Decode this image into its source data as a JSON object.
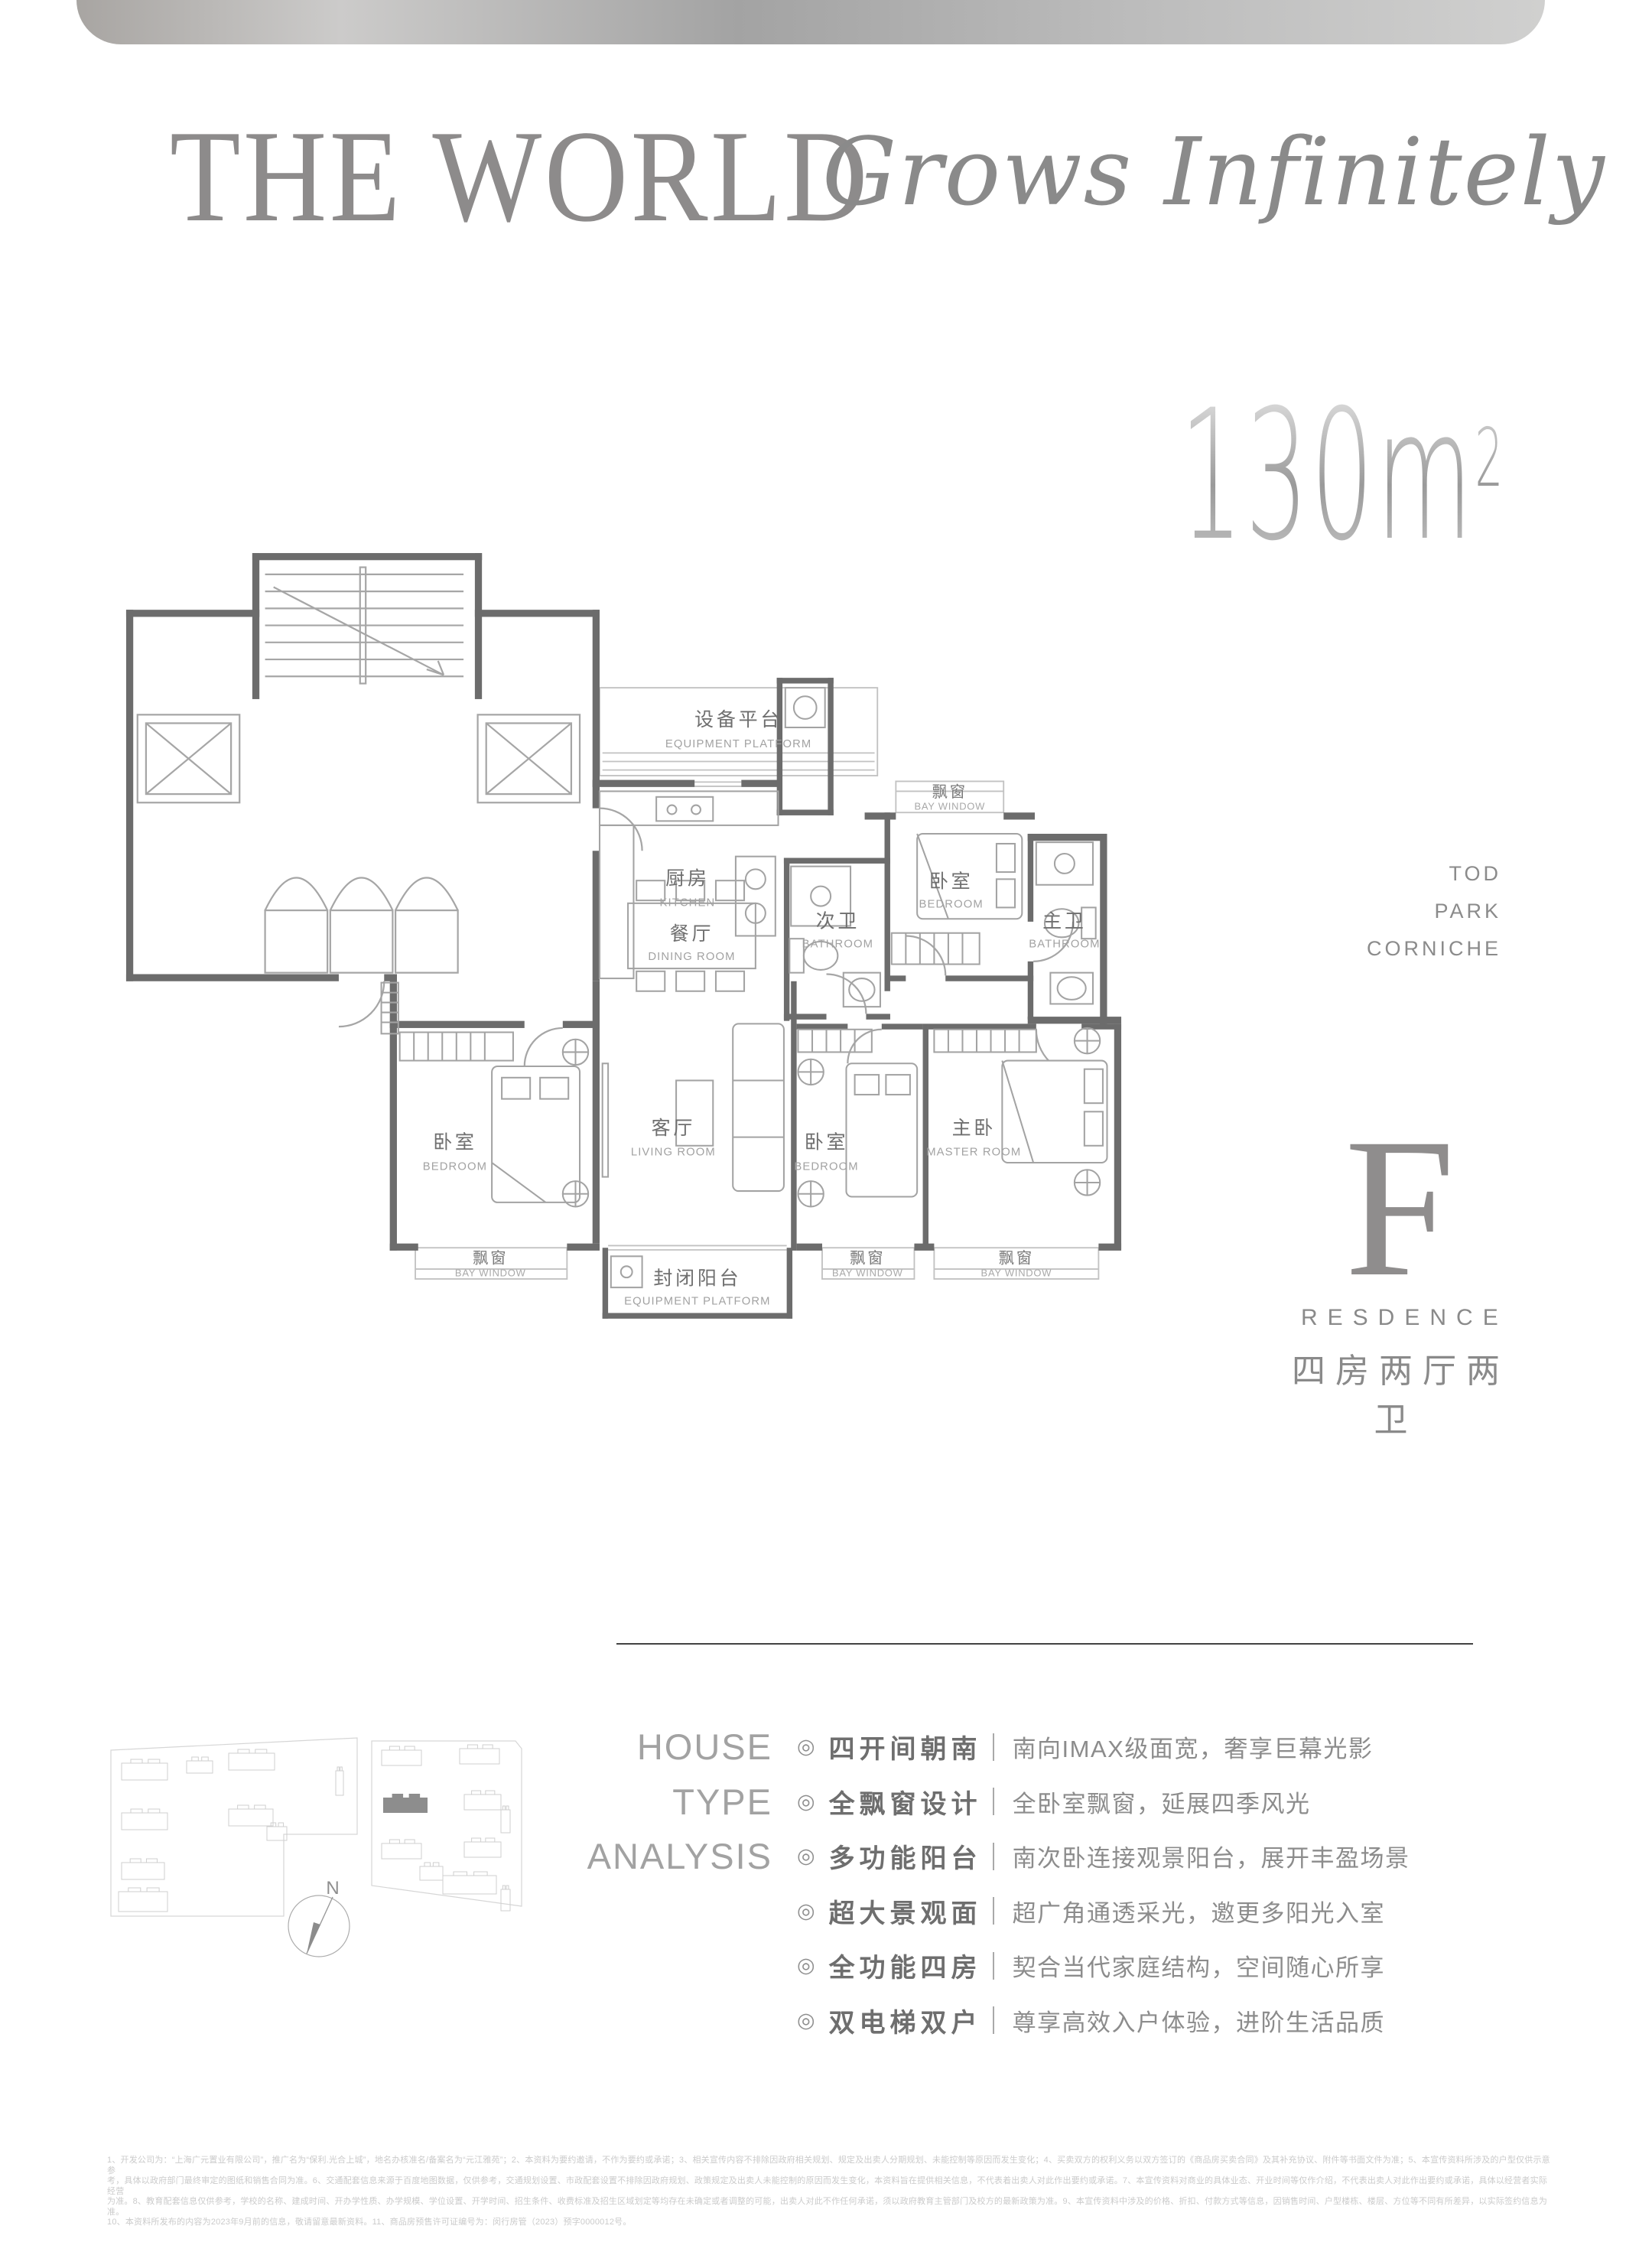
{
  "header": {
    "title": "THE WORLD",
    "subtitle": "Grows Infinitely"
  },
  "area_badge": {
    "value": "130",
    "unit": "m",
    "exponent": "2"
  },
  "location_tags": {
    "0": "TOD",
    "1": "PARK",
    "2": "CORNICHE"
  },
  "residence": {
    "letter": "F",
    "label": "RESDENCE",
    "type": "四房两厅两卫"
  },
  "plan": {
    "rooms": {
      "equipment_platform": {
        "zh": "设备平台",
        "en": "EQUIPMENT PLATFORM"
      },
      "kitchen": {
        "zh": "厨房",
        "en": "KITCHEN"
      },
      "dining": {
        "zh": "餐厅",
        "en": "DINING ROOM"
      },
      "bath_second": {
        "zh": "次卫",
        "en": "BATHROOM"
      },
      "bath_master": {
        "zh": "主卫",
        "en": "BATHROOM"
      },
      "bedroom_north": {
        "zh": "卧室",
        "en": "BEDROOM"
      },
      "bedroom_west": {
        "zh": "卧室",
        "en": "BEDROOM"
      },
      "bedroom_south": {
        "zh": "卧室",
        "en": "BEDROOM"
      },
      "living": {
        "zh": "客厅",
        "en": "LIVING ROOM"
      },
      "master": {
        "zh": "主卧",
        "en": "MASTER ROOM"
      },
      "bay": {
        "zh": "飘窗",
        "en": "BAY WINDOW"
      },
      "balcony": {
        "zh": "封闭阳台",
        "en": "EQUIPMENT PLATFORM"
      }
    }
  },
  "compass": {
    "label": "N"
  },
  "analysis": {
    "heading": {
      "0": "HOUSE",
      "1": "TYPE",
      "2": "ANALYSIS"
    },
    "bullet": "◎",
    "items": [
      {
        "title": "四开间朝南",
        "desc": "南向IMAX级面宽，奢享巨幕光影"
      },
      {
        "title": "全飘窗设计",
        "desc": "全卧室飘窗，延展四季风光"
      },
      {
        "title": "多功能阳台",
        "desc": "南次卧连接观景阳台，展开丰盈场景"
      },
      {
        "title": "超大景观面",
        "desc": "超广角通透采光，邀更多阳光入室"
      },
      {
        "title": "全功能四房",
        "desc": "契合当代家庭结构，空间随心所享"
      },
      {
        "title": "双电梯双户",
        "desc": "尊享高效入户体验，进阶生活品质"
      }
    ]
  },
  "disclaimer": {
    "lines": [
      "1、开发公司为：“上海广元置业有限公司”，推广名为“保利.光合上城”，地名办核准名/备案名为“元江雅苑”；2、本资料为要约邀请，不作为要约或承诺；3、相关宣传内容不排除因政府相关规划、规定及出卖人分期规划、未能控制等原因而发生变化；4、买卖双方的权利义务以双方签订的《商品房买卖合同》及其补充协议、附件等书面文件为准；5、本宣传资料所涉及的户型仅供示意参",
      "考，具体以政府部门最终审定的图纸和销售合同为准。6、交通配套信息来源于百度地图数据，仅供参考，交通规划设置、市政配套设置不排除因政府规划、政策规定及出卖人未能控制的原因而发生变化，本资料旨在提供相关信息，不代表着出卖人对此作出要约或承诺。7、本宣传资料对商业的具体业态、开业时间等仅作介绍，不代表出卖人对此作出要约或承诺，具体以经营者实际经营",
      "为准。8、教育配套信息仅供参考，学校的名称、建成时间、开办学性质、办学规模、学位设置、开学时间、招生条件、收费标准及招生区域划定等均存在未确定或者调整的可能，出卖人对此不作任何承诺，须以政府教育主管部门及校方的最新政策为准。9、本宣传资料中涉及的价格、折扣、付款方式等信息，因销售时间、户型楼栋、楼层、方位等不同有所差异，以实际签约信息为准。",
      "10、本资料所发布的内容为2023年9月前的信息，敬请留意最新资料。11、商品房预售许可证编号为：闵行房管（2023）预字0000012号。"
    ]
  }
}
